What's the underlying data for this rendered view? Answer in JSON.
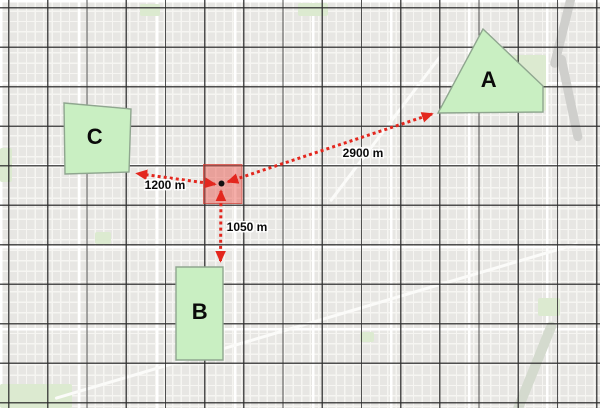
{
  "view": {
    "type": "map-measurement-overlay"
  },
  "colors": {
    "measure_red": "#e3271e",
    "zone_fill": "#c9efc2",
    "zone_border": "#8fa68f",
    "highlight_fill": "#e84b40",
    "highlight_border": "#cc3c33",
    "grid_line": "#2d2d2d",
    "origin_dot": "#111111",
    "basemap_bg": "#e7e6e3"
  },
  "zones": {
    "a": {
      "label": "A"
    },
    "b": {
      "label": "B"
    },
    "c": {
      "label": "C"
    }
  },
  "origin": {
    "marker": "measurement-origin-point"
  },
  "measurements": {
    "to_a": {
      "label": "2900 m",
      "meters": 2900,
      "target": "A"
    },
    "to_c": {
      "label": "1200 m",
      "meters": 1200,
      "target": "C"
    },
    "to_b": {
      "label": "1050 m",
      "meters": 1050,
      "target": "B"
    }
  }
}
